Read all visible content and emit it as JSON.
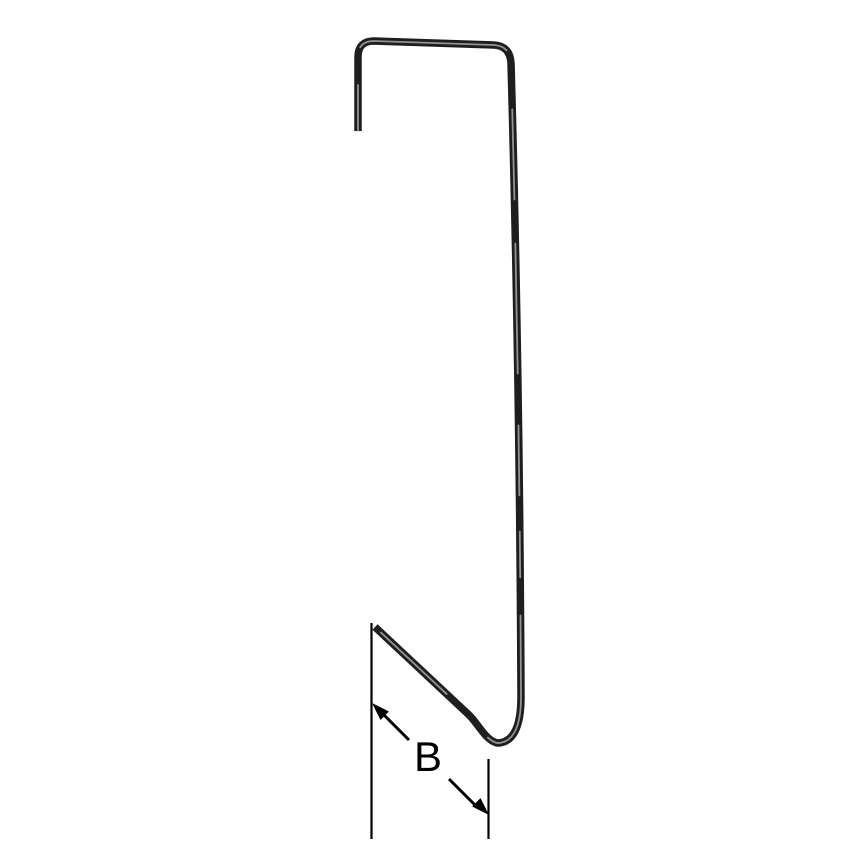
{
  "diagram": {
    "dimension_label": "B",
    "colors": {
      "background": "#ffffff",
      "wire": "#1e1e1e",
      "wire_highlight": "#a8a8a8",
      "annotation": "#000000"
    }
  }
}
